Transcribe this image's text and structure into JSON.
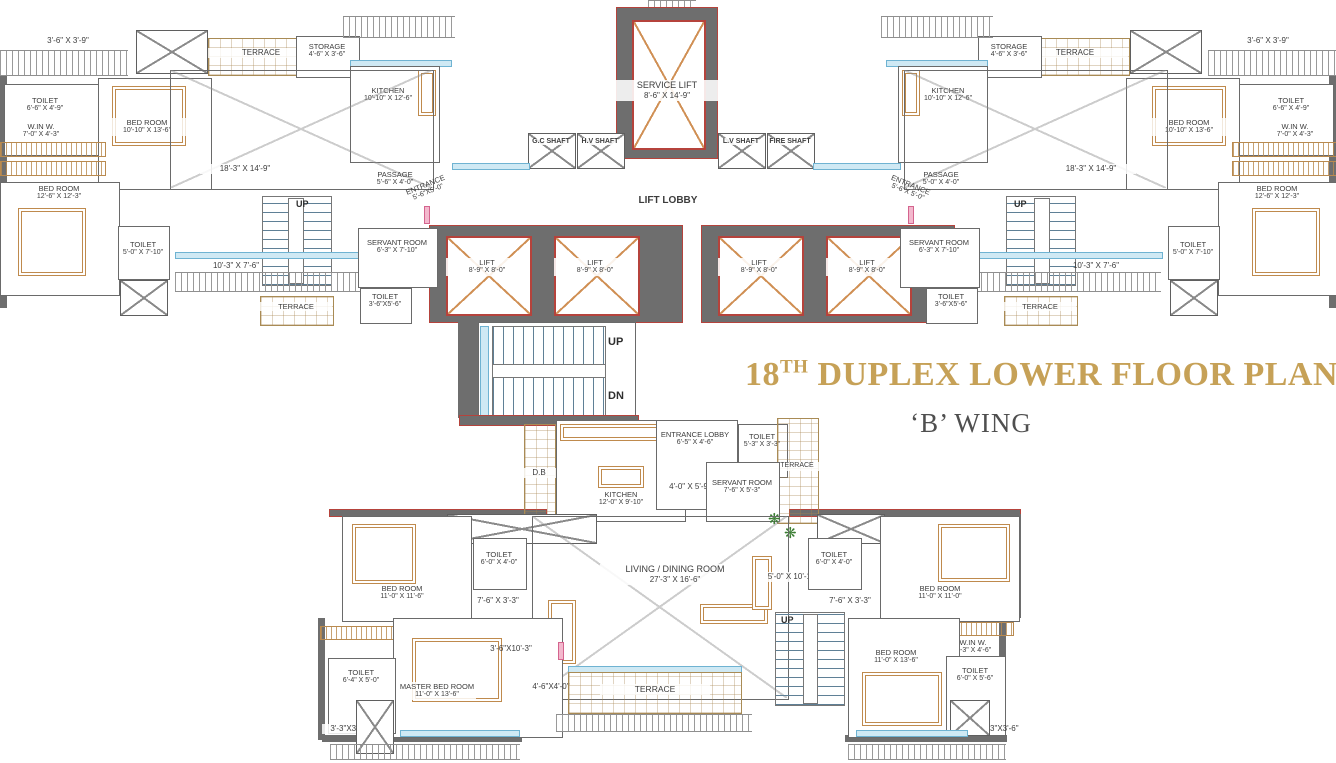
{
  "title": {
    "number": "18",
    "sup": "TH",
    "text": "DUPLEX LOWER FLOOR PLAN",
    "wing": "‘B’ WING"
  },
  "icons": {
    "plant": "❋"
  },
  "colors": {
    "title_gold": "#C6A157",
    "wall_gray": "#6E6E6E",
    "wall_red": "#B5433C",
    "window_blue": "#CFE9F4",
    "furniture_tan": "#BF8A4D",
    "door_pink": "#F3B8CD"
  },
  "core": {
    "service_lift": {
      "name": "SERVICE LIFT",
      "dims": "8'-6\" X 14'-9\""
    },
    "shafts": [
      "G.C SHAFT",
      "H.V SHAFT",
      "L.V SHAFT",
      "FIRE SHAFT"
    ],
    "lift_lobby": "LIFT LOBBY",
    "lift": {
      "name": "LIFT",
      "dims": "8'-9\" X 8'-0\""
    },
    "stair": {
      "up": "UP",
      "dn": "DN"
    }
  },
  "left_wing": {
    "corner_dim": "3'-6\" X 3'-9\"",
    "toilet1": {
      "name": "TOILET",
      "dims": "6'-6\" X 4'-9\""
    },
    "bedroom1": {
      "name": "BED ROOM",
      "dims": "10'-10\" X 13'-6\""
    },
    "winw": {
      "name": "W.IN W.",
      "dims": "7'-0\" X 4'-3\""
    },
    "bedroom2": {
      "name": "BED ROOM",
      "dims": "12'-6\" X 12'-3\""
    },
    "terrace": "TERRACE",
    "storage": {
      "name": "STORAGE",
      "dims": "4'-6\" X 3'-6\""
    },
    "kitchen": {
      "name": "KITCHEN",
      "dims": "10'-10\" X 12'-6\""
    },
    "living_dim": "18'-3\" X 14'-9\"",
    "passage": {
      "name": "PASSAGE",
      "dims": "5'-6\" X 4'-0\""
    },
    "entrance": {
      "name": "ENTRANCE",
      "dims": "5'-6\"X5'-0\""
    },
    "up": "UP",
    "balcony_dim": "10'-3\" X 7'-6\"",
    "servant": {
      "name": "SERVANT ROOM",
      "dims": "6'-3\" X 7'-10\""
    },
    "toilet2": {
      "name": "TOILET",
      "dims": "5'-0\" X 7'-10\""
    },
    "toilet3": {
      "name": "TOILET",
      "dims": "3'-6\"X5'-6\""
    },
    "terrace2": "TERRACE"
  },
  "right_wing": {
    "corner_dim": "3'-6\" X 3'-9\"",
    "toilet1": {
      "name": "TOILET",
      "dims": "6'-6\" X 4'-9\""
    },
    "bedroom1": {
      "name": "BED ROOM",
      "dims": "10'-10\" X 13'-6\""
    },
    "winw": {
      "name": "W.IN W.",
      "dims": "7'-0\" X 4'-3\""
    },
    "bedroom2": {
      "name": "BED ROOM",
      "dims": "12'-6\" X 12'-3\""
    },
    "terrace": "TERRACE",
    "storage": {
      "name": "STORAGE",
      "dims": "4'-6\" X 3'-6\""
    },
    "kitchen": {
      "name": "KITCHEN",
      "dims": "10'-10\" X 12'-6\""
    },
    "living_dim": "18'-3\" X 14'-9\"",
    "passage": {
      "name": "PASSAGE",
      "dims": "5'-0\" X 4'-0\""
    },
    "entrance": {
      "name": "ENTRANCE",
      "dims": "5'-6\"X 5'-0\""
    },
    "up": "UP",
    "balcony_dim": "10'-3\" X 7'-6\"",
    "servant": {
      "name": "SERVANT ROOM",
      "dims": "6'-3\" X 7'-10\""
    },
    "toilet2": {
      "name": "TOILET",
      "dims": "5'-0\" X 7'-10\""
    },
    "toilet3": {
      "name": "TOILET",
      "dims": "3'-6\"X5'-6\""
    },
    "terrace2": "TERRACE"
  },
  "lower_unit": {
    "db": "D.B",
    "kitchen": {
      "name": "KITCHEN",
      "dims": "12'-0\" X 9'-10\""
    },
    "entrance_lobby": {
      "name": "ENTRANCE LOBBY",
      "dims": "6'-5\" X 4'-6\""
    },
    "toilet_lobby": {
      "name": "TOILET",
      "dims": "5'-3\" X 3'-3\""
    },
    "terrace_side": "TERRACE",
    "servant": {
      "name": "SERVANT ROOM",
      "dims": "7'-6\" X 5'-3\""
    },
    "dim_a": "4'-0\" X 5'-9\"",
    "dim_b": "5'-0\" X 10'-10\"",
    "bedroom_left": {
      "name": "BED ROOM",
      "dims": "11'-0\" X 11'-6\""
    },
    "toilet_left": {
      "name": "TOILET",
      "dims": "6'-0\" X 4'-0\""
    },
    "pass_left": "7'-6\" X 3'-3\"",
    "living": {
      "name": "LIVING / DINING ROOM",
      "dims": "27'-3\" X 16'-6\""
    },
    "bedroom_right_top": {
      "name": "BED ROOM",
      "dims": "11'-0\" X 11'-0\""
    },
    "toilet_right": {
      "name": "TOILET",
      "dims": "6'-0\" X 4'-0\""
    },
    "pass_right": "7'-6\" X 3'-3\"",
    "winw": {
      "name": "W.IN W.",
      "dims": "7'-3\" X 4'-6\""
    },
    "bedroom_right": {
      "name": "BED ROOM",
      "dims": "11'-0\" X 13'-6\""
    },
    "toilet_br": {
      "name": "TOILET",
      "dims": "6'-0\" X 5'-6\""
    },
    "corner_br": "3'-3\"X3'-6\"",
    "master": {
      "name": "MASTER BED ROOM",
      "dims": "11'-0\" X 13'-6\""
    },
    "toilet_master": {
      "name": "TOILET",
      "dims": "6'-4\" X 5'-0\""
    },
    "corner_bl": "3'-3\"X3'-6\"",
    "dim_c": "3'-6\"X10'-3\"",
    "dim_d": "4'-6\"X4'-0\"",
    "up": "UP",
    "terrace": "TERRACE"
  }
}
